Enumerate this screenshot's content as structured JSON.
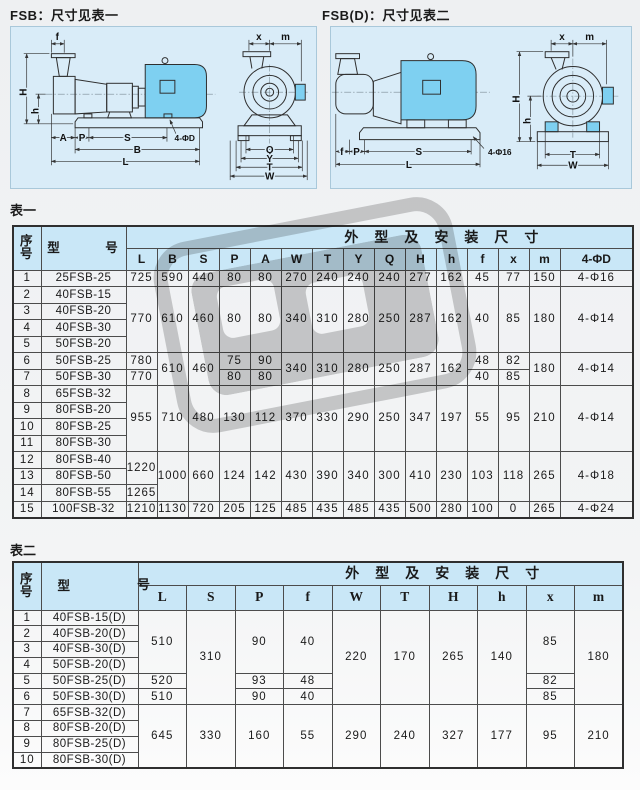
{
  "colors": {
    "header_blue": "#c9e7f7",
    "panel_blue": "#d9ecf8",
    "motor_blue": "#7ed0f1",
    "watermark_gray": "#cbcbcb"
  },
  "figures": {
    "fsb": {
      "title": "FSB：尺寸见表一"
    },
    "fsbd": {
      "title": "FSB(D)：尺寸见表二"
    },
    "dim_labels": {
      "f": "f",
      "H": "H",
      "h": "h",
      "A": "A",
      "P": "P",
      "S": "S",
      "B": "B",
      "L": "L",
      "x": "x",
      "m": "m",
      "Q": "Q",
      "Y": "Y",
      "T": "T",
      "W": "W",
      "holes_d": "4-ΦD",
      "holes_16": "4-Φ16"
    }
  },
  "table1": {
    "label": "表一",
    "head": [
      [
        {
          "t": "序号",
          "rs": 2,
          "cls": "xh"
        },
        {
          "t": "型　　　号",
          "rs": 2,
          "cls": "xh"
        },
        {
          "t": "外型及安装尺寸",
          "cs": 15,
          "cls": "group"
        }
      ],
      [
        "L",
        "B",
        "S",
        "P",
        "A",
        "W",
        "T",
        "Y",
        "Q",
        "H",
        "h",
        "f",
        "x",
        "m",
        "4-ΦD"
      ]
    ],
    "body": [
      [
        "1",
        "25FSB-25",
        "725",
        "590",
        "440",
        "80",
        "80",
        "270",
        "240",
        "240",
        "240",
        "277",
        "162",
        "45",
        "77",
        "150",
        "4-Φ16"
      ],
      [
        "2",
        "40FSB-15",
        {
          "t": "770",
          "rs": 4
        },
        {
          "t": "610",
          "rs": 4
        },
        {
          "t": "460",
          "rs": 4
        },
        {
          "t": "80",
          "rs": 4
        },
        {
          "t": "80",
          "rs": 4
        },
        {
          "t": "340",
          "rs": 4
        },
        {
          "t": "310",
          "rs": 4
        },
        {
          "t": "280",
          "rs": 4
        },
        {
          "t": "250",
          "rs": 4
        },
        {
          "t": "287",
          "rs": 4
        },
        {
          "t": "162",
          "rs": 4
        },
        {
          "t": "40",
          "rs": 4
        },
        {
          "t": "85",
          "rs": 4
        },
        {
          "t": "180",
          "rs": 4
        },
        {
          "t": "4-Φ14",
          "rs": 4
        }
      ],
      [
        "3",
        "40FSB-20"
      ],
      [
        "4",
        "40FSB-30"
      ],
      [
        "5",
        "50FSB-20"
      ],
      [
        "6",
        "50FSB-25",
        "780",
        {
          "t": "610",
          "rs": 2
        },
        {
          "t": "460",
          "rs": 2
        },
        "75",
        "90",
        {
          "t": "340",
          "rs": 2
        },
        {
          "t": "310",
          "rs": 2
        },
        {
          "t": "280",
          "rs": 2
        },
        {
          "t": "250",
          "rs": 2
        },
        {
          "t": "287",
          "rs": 2
        },
        {
          "t": "162",
          "rs": 2
        },
        "48",
        "82",
        {
          "t": "180",
          "rs": 2
        },
        {
          "t": "4-Φ14",
          "rs": 2
        }
      ],
      [
        "7",
        "50FSB-30",
        "770",
        "80",
        "80",
        "40",
        "85"
      ],
      [
        "8",
        "65FSB-32",
        {
          "t": "955",
          "rs": 4
        },
        {
          "t": "710",
          "rs": 4
        },
        {
          "t": "480",
          "rs": 4
        },
        {
          "t": "130",
          "rs": 4
        },
        {
          "t": "112",
          "rs": 4
        },
        {
          "t": "370",
          "rs": 4
        },
        {
          "t": "330",
          "rs": 4
        },
        {
          "t": "290",
          "rs": 4
        },
        {
          "t": "250",
          "rs": 4
        },
        {
          "t": "347",
          "rs": 4
        },
        {
          "t": "197",
          "rs": 4
        },
        {
          "t": "55",
          "rs": 4
        },
        {
          "t": "95",
          "rs": 4
        },
        {
          "t": "210",
          "rs": 4
        },
        {
          "t": "4-Φ14",
          "rs": 4
        }
      ],
      [
        "9",
        "80FSB-20"
      ],
      [
        "10",
        "80FSB-25"
      ],
      [
        "11",
        "80FSB-30"
      ],
      [
        "12",
        "80FSB-40",
        {
          "t": "1220",
          "rs": 2
        },
        {
          "t": "1000",
          "rs": 3
        },
        {
          "t": "660",
          "rs": 3
        },
        {
          "t": "124",
          "rs": 3
        },
        {
          "t": "142",
          "rs": 3
        },
        {
          "t": "430",
          "rs": 3
        },
        {
          "t": "390",
          "rs": 3
        },
        {
          "t": "340",
          "rs": 3
        },
        {
          "t": "300",
          "rs": 3
        },
        {
          "t": "410",
          "rs": 3
        },
        {
          "t": "230",
          "rs": 3
        },
        {
          "t": "103",
          "rs": 3
        },
        {
          "t": "118",
          "rs": 3
        },
        {
          "t": "265",
          "rs": 3
        },
        {
          "t": "4-Φ18",
          "rs": 3
        }
      ],
      [
        "13",
        "80FSB-50"
      ],
      [
        "14",
        "80FSB-55",
        "1265"
      ],
      [
        "15",
        "100FSB-32",
        "1210",
        "1130",
        "720",
        "205",
        "125",
        "485",
        "435",
        "485",
        "435",
        "500",
        "280",
        "100",
        "0",
        "265",
        "4-Φ24"
      ]
    ]
  },
  "table2": {
    "label": "表二",
    "stray_char": "号",
    "head": [
      [
        {
          "t": "序号",
          "rs": 2,
          "cls": "xh"
        },
        {
          "t": "型",
          "rs": 2,
          "cls": "xh model2"
        },
        {
          "t": "外型及安装尺寸",
          "cs": 10,
          "cls": "group"
        }
      ],
      [
        "L",
        "S",
        "P",
        "f",
        "W",
        "T",
        "H",
        "h",
        "x",
        "m"
      ]
    ],
    "body": [
      [
        "1",
        "40FSB-15(D)",
        {
          "t": "510",
          "rs": 4
        },
        {
          "t": "310",
          "rs": 6
        },
        {
          "t": "90",
          "rs": 4
        },
        {
          "t": "40",
          "rs": 4
        },
        {
          "t": "220",
          "rs": 6
        },
        {
          "t": "170",
          "rs": 6
        },
        {
          "t": "265",
          "rs": 6
        },
        {
          "t": "140",
          "rs": 6
        },
        {
          "t": "85",
          "rs": 4
        },
        {
          "t": "180",
          "rs": 6
        }
      ],
      [
        "2",
        "40FSB-20(D)"
      ],
      [
        "3",
        "40FSB-30(D)"
      ],
      [
        "4",
        "50FSB-20(D)"
      ],
      [
        "5",
        "50FSB-25(D)",
        "520",
        "93",
        "48",
        "82"
      ],
      [
        "6",
        "50FSB-30(D)",
        "510",
        "90",
        "40",
        "85"
      ],
      [
        "7",
        "65FSB-32(D)",
        {
          "t": "645",
          "rs": 4
        },
        {
          "t": "330",
          "rs": 4
        },
        {
          "t": "160",
          "rs": 4
        },
        {
          "t": "55",
          "rs": 4
        },
        {
          "t": "290",
          "rs": 4
        },
        {
          "t": "240",
          "rs": 4
        },
        {
          "t": "327",
          "rs": 4
        },
        {
          "t": "177",
          "rs": 4
        },
        {
          "t": "95",
          "rs": 4
        },
        {
          "t": "210",
          "rs": 4
        }
      ],
      [
        "8",
        "80FSB-20(D)"
      ],
      [
        "9",
        "80FSB-25(D)"
      ],
      [
        "10",
        "80FSB-30(D)"
      ]
    ]
  }
}
